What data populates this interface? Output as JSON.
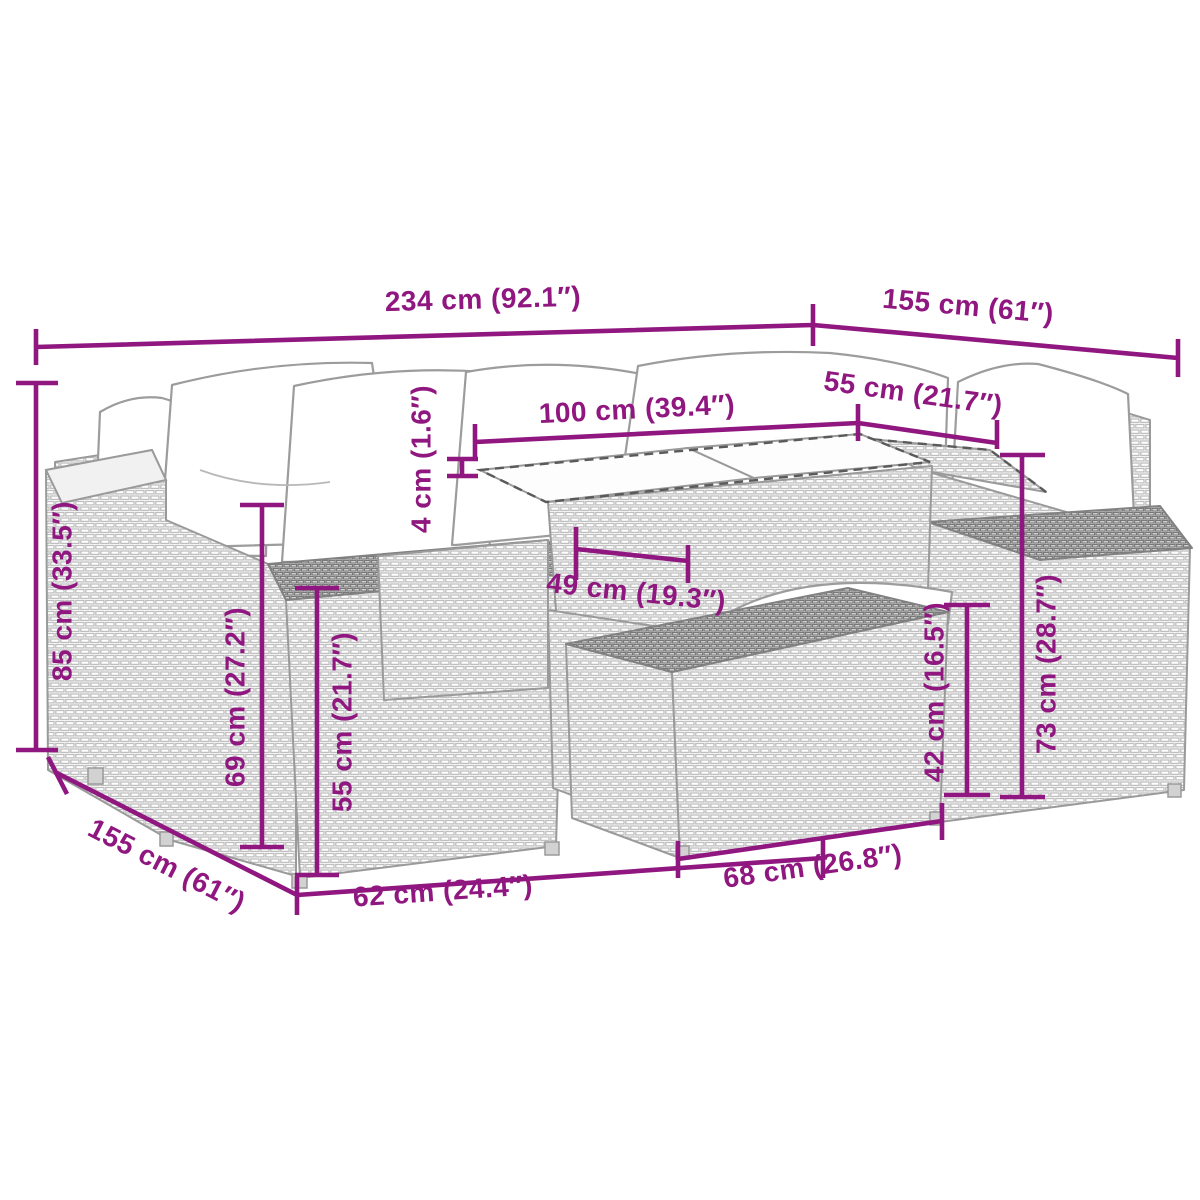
{
  "figure": {
    "kind": "product-dimension-diagram",
    "subject": "wicker-garden-lounge-set",
    "parts": [
      "back-cushions",
      "left-armrest",
      "left-seat-block",
      "glass-top-table",
      "corner-seat",
      "right-armrest",
      "ottoman"
    ]
  },
  "colors": {
    "background": "#ffffff",
    "dimension_accent": "#8F177F",
    "lineart_gray": "#9a9a9a"
  },
  "dims": {
    "overall_width": {
      "text": "234 cm (92.1″)"
    },
    "overall_depth_right": {
      "text": "155 cm (61″)"
    },
    "corner_seat_width": {
      "text": "55 cm (21.7″)"
    },
    "table_length": {
      "text": "100 cm (39.4″)"
    },
    "tabletop_thickness": {
      "text": "4 cm (1.6″)"
    },
    "table_depth": {
      "text": "49 cm (19.3″)"
    },
    "back_height": {
      "text": "85 cm (33.5″)"
    },
    "arm_height": {
      "text": "69 cm (27.2″)"
    },
    "seat_block_height": {
      "text": "55 cm (21.7″)"
    },
    "overall_depth_left": {
      "text": "155 cm (61″)"
    },
    "seat_width": {
      "text": "62 cm (24.4″)"
    },
    "ottoman_width": {
      "text": "68 cm (26.8″)"
    },
    "ottoman_height": {
      "text": "42 cm (16.5″)"
    },
    "right_arm_height": {
      "text": "73 cm (28.7″)"
    }
  }
}
